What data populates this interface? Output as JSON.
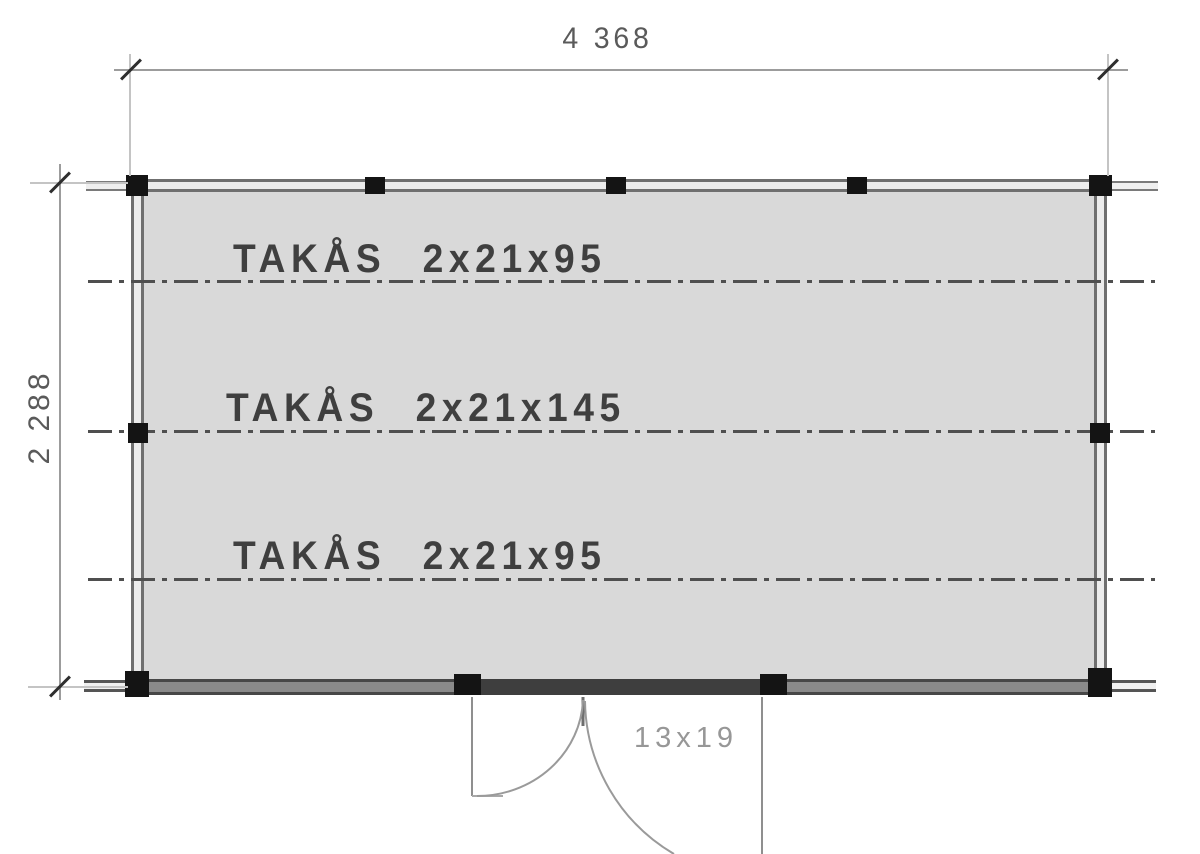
{
  "plan": {
    "dimensions": {
      "width": "4 368",
      "height": "2 288"
    },
    "rafters": [
      {
        "label": "TAKÅS 2x21x95"
      },
      {
        "label": "TAKÅS 2x21x145"
      },
      {
        "label": "TAKÅS 2x21x95"
      }
    ],
    "door": {
      "label": "13x19"
    },
    "colors": {
      "roof_fill": "#d9d9d9",
      "wall_line": "#6f6f6f",
      "post": "#141414",
      "centerline": "#4f4f4f",
      "dim_line": "#9c9c9c",
      "label_text": "#3f3f3f"
    }
  }
}
